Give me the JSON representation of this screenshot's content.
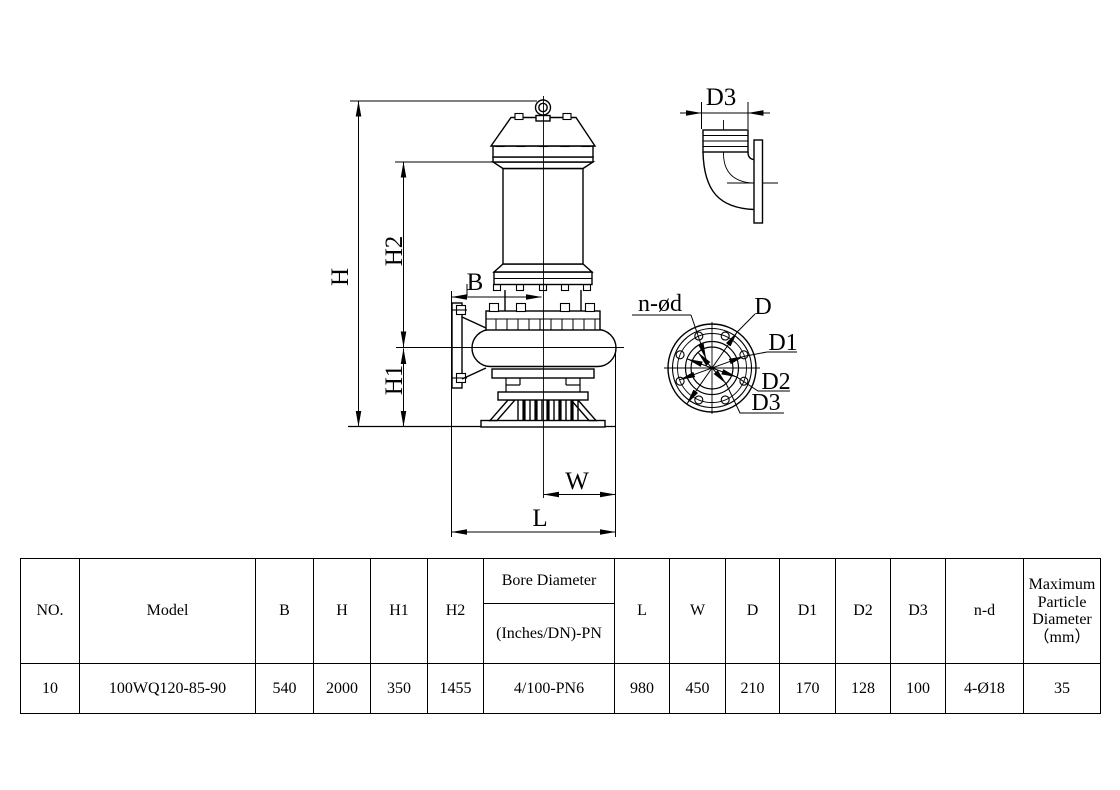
{
  "drawing": {
    "line_color": "#000000",
    "side_view": {
      "dim_h": "H",
      "dim_h1": "H1",
      "dim_h2": "H2",
      "dim_b": "B",
      "dim_w": "W",
      "dim_l": "L"
    },
    "elbow_view": {
      "dim_d3": "D3"
    },
    "flange_view": {
      "dim_n_od": "n-ød",
      "dim_d": "D",
      "dim_d1": "D1",
      "dim_d2": "D2",
      "dim_d3": "D3"
    }
  },
  "table": {
    "headers": {
      "no": "NO.",
      "model": "Model",
      "b": "B",
      "h": "H",
      "h1": "H1",
      "h2": "H2",
      "bore_top": "Bore Diameter",
      "bore_bottom": "(Inches/DN)-PN",
      "l": "L",
      "w": "W",
      "d": "D",
      "d1": "D1",
      "d2": "D2",
      "d3": "D3",
      "nd": "n-d",
      "max_line1": "Maximum",
      "max_line2": "Particle",
      "max_line3": "Diameter",
      "max_line4": "（mm）"
    },
    "row": {
      "no": "10",
      "model": "100WQ120-85-90",
      "b": "540",
      "h": "2000",
      "h1": "350",
      "h2": "1455",
      "bore": "4/100-PN6",
      "l": "980",
      "w": "450",
      "d": "210",
      "d1": "170",
      "d2": "128",
      "d3": "100",
      "nd": "4-Ø18",
      "max": "35"
    }
  }
}
